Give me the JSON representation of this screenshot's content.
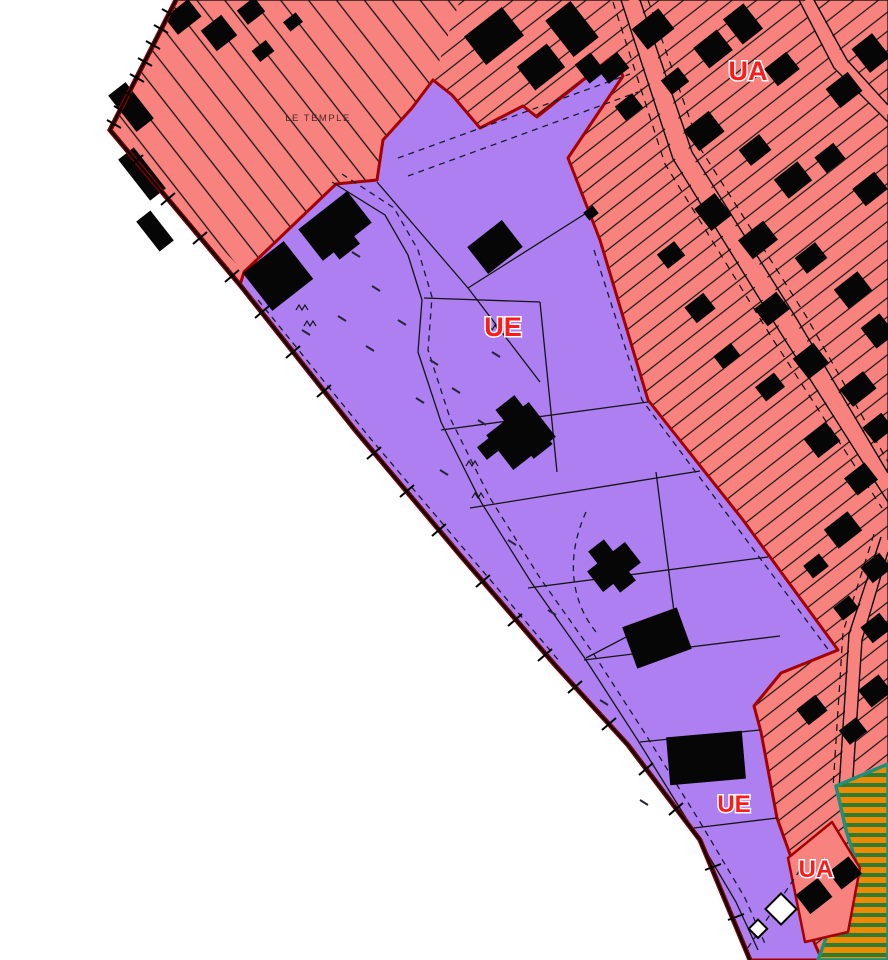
{
  "map": {
    "title": "Plan de zonage",
    "labels": {
      "place": {
        "text": "LE TEMPLE"
      },
      "ua_north": {
        "text": "UA"
      },
      "ue_central": {
        "text": "UE"
      },
      "ue_south": {
        "text": "UE"
      },
      "ua_south": {
        "text": "UA"
      }
    },
    "zones": [
      {
        "code": "UA",
        "kind": "urban-zone",
        "fill": "#F8837E"
      },
      {
        "code": "UE",
        "kind": "equipment-zone",
        "fill": "#AE7FF0"
      },
      {
        "code": "hatched-reserve",
        "kind": "hatched-zone",
        "fill": "#EE8A00",
        "stripe": "#2E7B33",
        "border": "#1D9077"
      }
    ],
    "colors": {
      "background": "#FFFFFF",
      "ua_pink": "#F8837E",
      "ue_purple": "#AE7FF0",
      "zone_border_red": "#A50000",
      "edge_red": "#8B0000",
      "edge_black": "#000000",
      "label_red": "#FF1A1A",
      "building_black": "#060606",
      "hatch_orange": "#EE8A00",
      "hatch_green": "#2E7B33",
      "hatch_border_teal": "#1D9077",
      "place_label_color": "#4A2828"
    }
  }
}
